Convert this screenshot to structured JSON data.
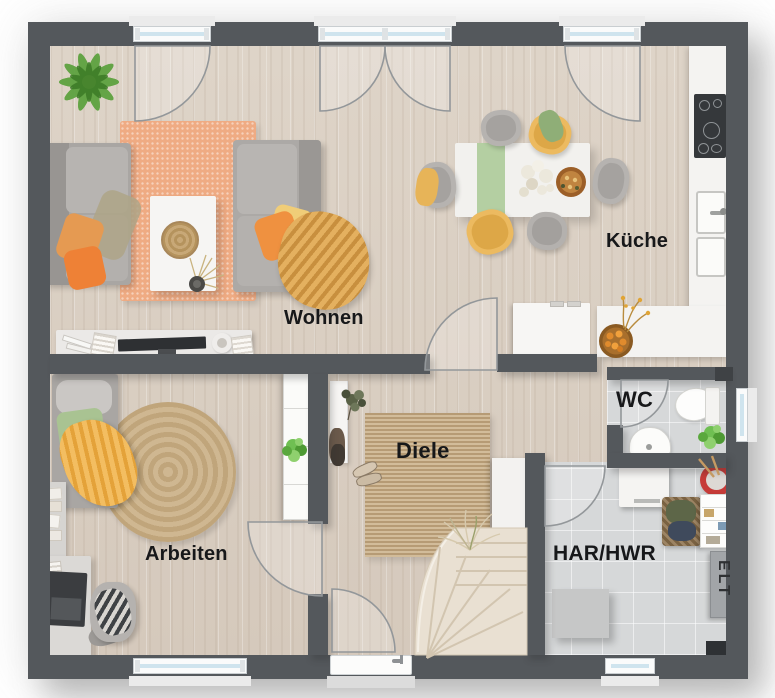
{
  "floorplan": {
    "rooms": [
      {
        "id": "wohnen",
        "label": "Wohnen"
      },
      {
        "id": "kueche",
        "label": "Küche"
      },
      {
        "id": "arbeiten",
        "label": "Arbeiten"
      },
      {
        "id": "diele",
        "label": "Diele"
      },
      {
        "id": "wc",
        "label": "WC"
      },
      {
        "id": "har-hwr",
        "label": "HAR/HWR"
      },
      {
        "id": "elt",
        "label": "ELT"
      }
    ],
    "colors": {
      "wall": "#54585c",
      "wood_floor": "#dacfc3",
      "tile_floor": "#d6d8d9",
      "rug_orange": "#efab83",
      "rug_jute": "#c7ac85",
      "sofa_gray": "#b2afac",
      "accent_yellow": "#ecba60",
      "accent_orange": "#ee8c3f",
      "plant_green": "#5da23b",
      "counter_white": "#f4f3f1",
      "stairs": "#e9e0d2",
      "window_glass": "#cfe4ee"
    }
  }
}
